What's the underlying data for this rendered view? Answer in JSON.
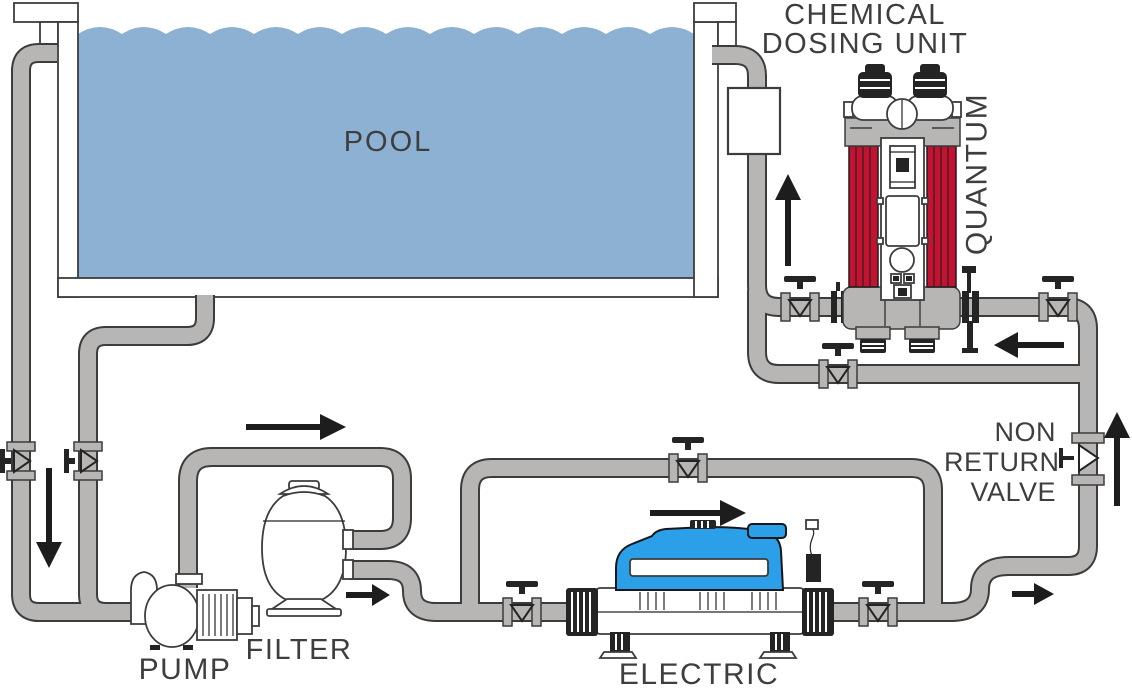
{
  "labels": {
    "pool": "POOL",
    "pump": "PUMP",
    "filter": "FILTER",
    "electric_heater": "ELECTRIC HEATER",
    "chemical_dosing_unit": "CHEMICAL DOSING UNIT",
    "quantum": "QUANTUM",
    "non_return_valve": "NON RETURN VALVE"
  },
  "colors": {
    "pool_water": "#8DB1D3",
    "pipe": "#B7B6B4",
    "pipe_outline": "#3C3C3C",
    "quantum_red": "#C41230",
    "heater_blue": "#2B9FE8",
    "line": "#1D1D1D",
    "label_text": "#3E3E3E"
  },
  "components": [
    {
      "name": "pool",
      "label": "POOL"
    },
    {
      "name": "pump",
      "label": "PUMP"
    },
    {
      "name": "filter",
      "label": "FILTER"
    },
    {
      "name": "electric-heater",
      "label": "ELECTRIC HEATER"
    },
    {
      "name": "chemical-dosing-unit",
      "label": "CHEMICAL DOSING UNIT"
    },
    {
      "name": "quantum-uv-unit",
      "label": "QUANTUM"
    },
    {
      "name": "non-return-valve",
      "label": "NON RETURN VALVE"
    },
    {
      "name": "isolation-valves",
      "count": 8
    }
  ],
  "flow_arrows": [
    {
      "id": "pool-suction",
      "direction": "down"
    },
    {
      "id": "pump-to-filter",
      "direction": "right"
    },
    {
      "id": "filter-outlet",
      "direction": "right"
    },
    {
      "id": "heater-bypass",
      "direction": "right"
    },
    {
      "id": "to-non-return-valve",
      "direction": "right"
    },
    {
      "id": "non-return-valve-riser",
      "direction": "up"
    },
    {
      "id": "quantum-outlet",
      "direction": "left"
    },
    {
      "id": "return-to-pool",
      "direction": "up"
    }
  ]
}
